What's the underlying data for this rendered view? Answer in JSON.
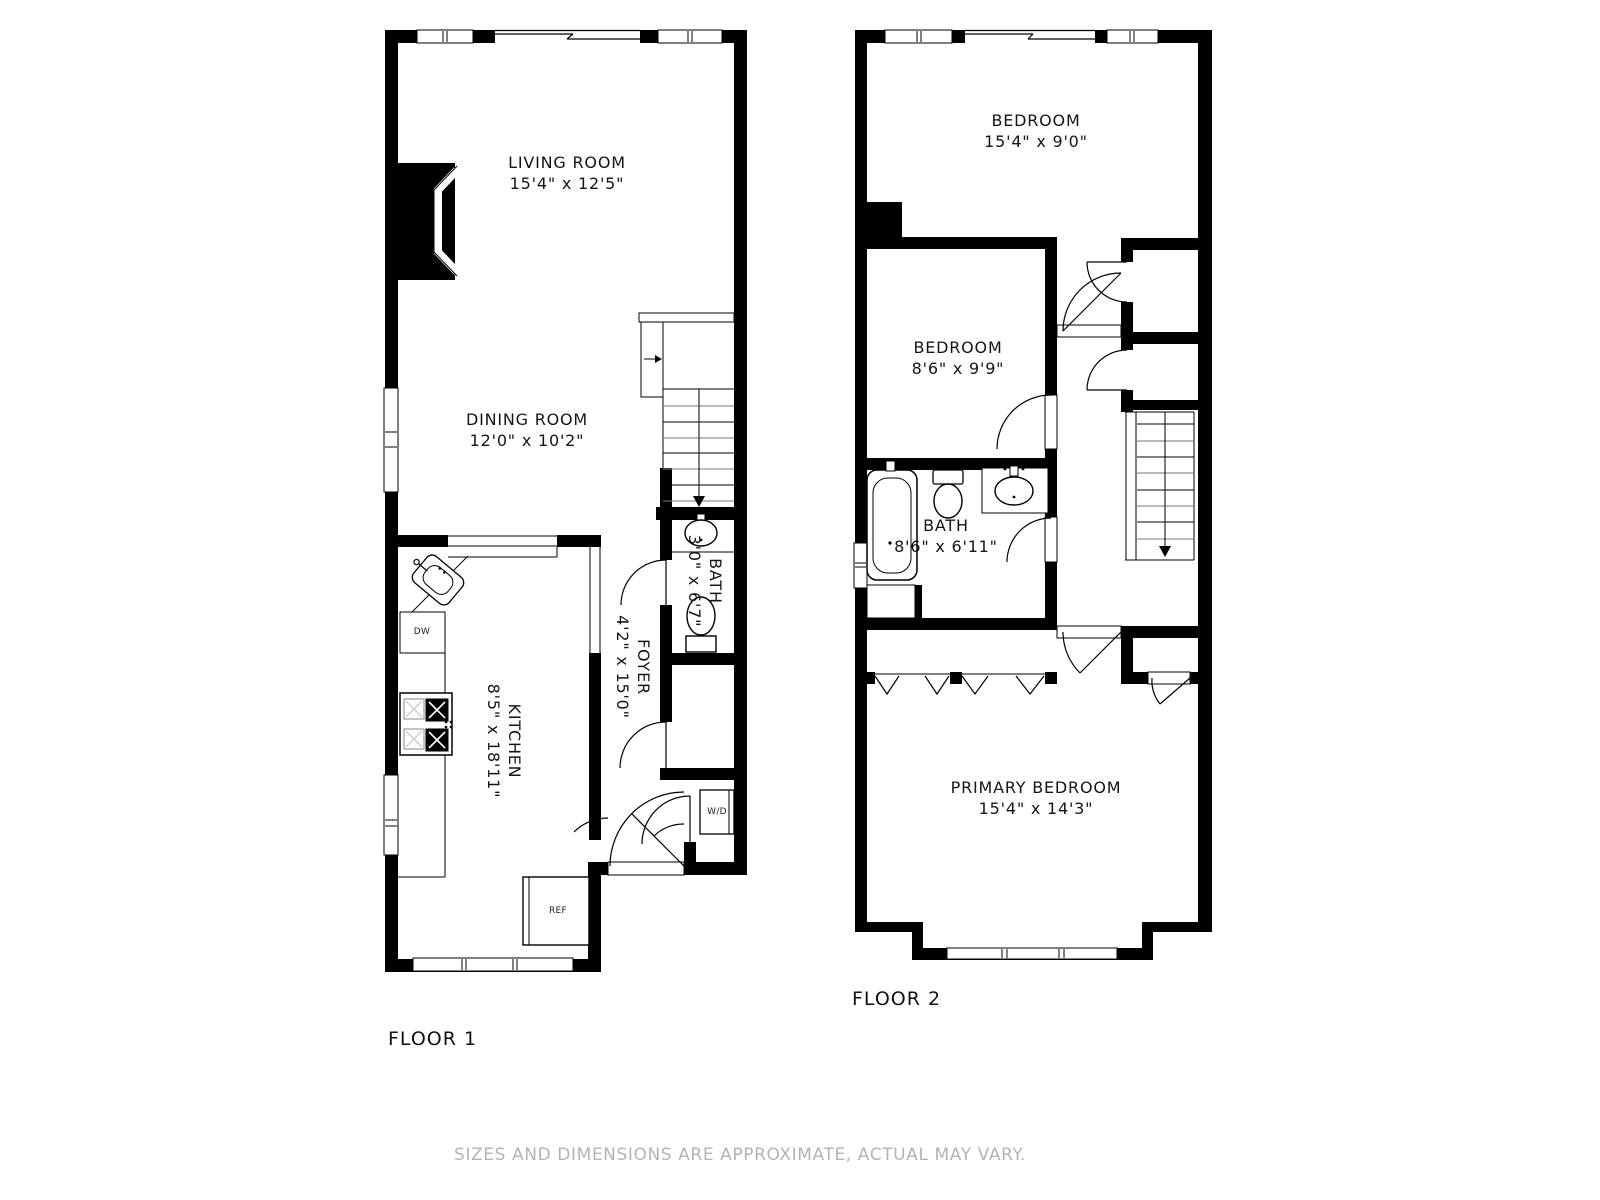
{
  "disclaimer": "SIZES AND DIMENSIONS ARE APPROXIMATE, ACTUAL MAY VARY.",
  "floor1": {
    "label": "FLOOR 1",
    "rooms": {
      "living": {
        "name": "LIVING ROOM",
        "dims": "15'4\" x 12'5\""
      },
      "dining": {
        "name": "DINING ROOM",
        "dims": "12'0\" x 10'2\""
      },
      "kitchen": {
        "name": "KITCHEN",
        "dims": "8'5\" x 18'11\""
      },
      "foyer": {
        "name": "FOYER",
        "dims": "4'2\" x 15'0\""
      },
      "bath": {
        "name": "BATH",
        "dims": "3'0\" x 6'7\""
      }
    },
    "appliances": {
      "dishwasher": "DW",
      "refrigerator": "REF",
      "washer_dryer": "W/D"
    }
  },
  "floor2": {
    "label": "FLOOR 2",
    "rooms": {
      "bedroom1": {
        "name": "BEDROOM",
        "dims": "15'4\" x 9'0\""
      },
      "bedroom2": {
        "name": "BEDROOM",
        "dims": "8'6\" x 9'9\""
      },
      "bath": {
        "name": "BATH",
        "dims": "8'6\" x 6'11\""
      },
      "primary": {
        "name": "PRIMARY BEDROOM",
        "dims": "15'4\" x 14'3\""
      }
    }
  }
}
